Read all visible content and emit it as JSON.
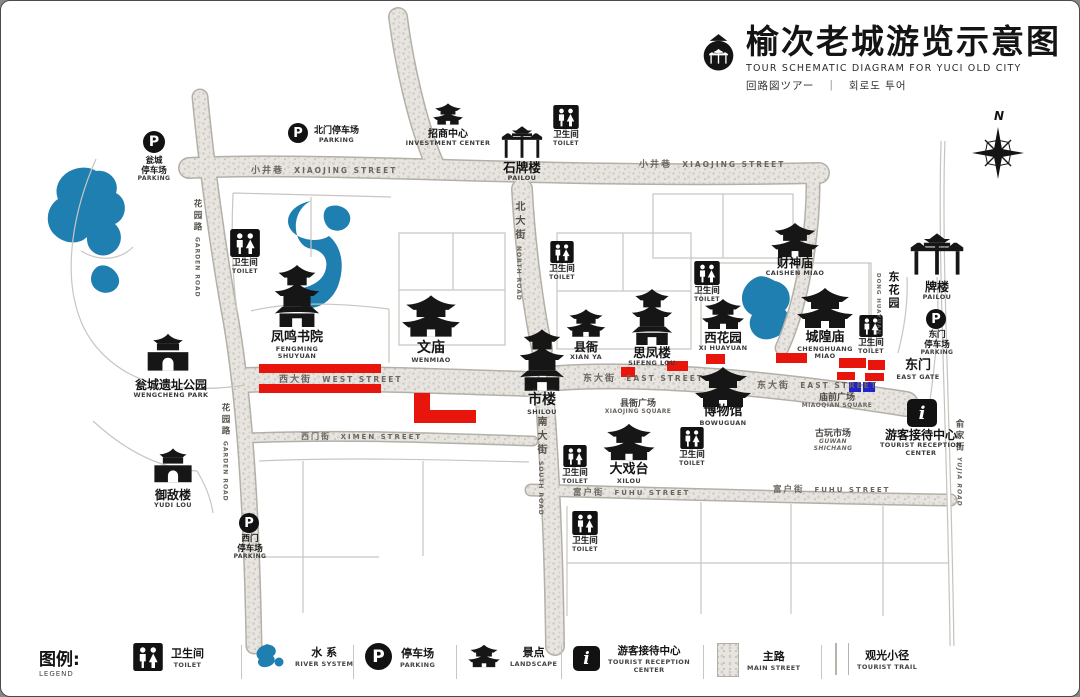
{
  "title": {
    "zh": "榆次老城游览示意图",
    "en": "TOUR SCHEMATIC DIAGRAM FOR YUCI OLD CITY",
    "sub": "回路図ツアー　｜　회로도 투어"
  },
  "compass": {
    "n": "N"
  },
  "colors": {
    "water": "#1e7fb0",
    "route_red": "#e8150d",
    "route_blue": "#2323cc",
    "road_fill": "#e8e5e0",
    "ink": "#141414"
  },
  "toilet": {
    "zh": "卫生间",
    "en": "TOILET"
  },
  "streets": {
    "xiaojing_zh": "小井巷",
    "xiaojing_en": "XIAOJING STREET",
    "west_zh": "西大街",
    "west_en": "WEST STREET",
    "east_zh": "东大街",
    "east_en": "EAST STREET",
    "ximen_zh": "西门街",
    "ximen_en": "XIMEN STREET",
    "fuhu_zh": "富户街",
    "fuhu_en": "FUHU STREET",
    "north_zh": "北大街",
    "north_en": "NORTH ROAD",
    "south_zh": "南大街",
    "south_en": "SOUTH ROAD",
    "garden_zh": "花园路",
    "garden_en": "GARDEN ROAD",
    "yujia_zh": "俞家街",
    "yujia_en": "YUJIA ROAD"
  },
  "landmarks": {
    "investment": {
      "zh": "招商中心",
      "en": "INVESTMENT CENTER"
    },
    "shipailou": {
      "zh": "石牌楼",
      "en": "PAILOU"
    },
    "fengming": {
      "zh": "凤鸣书院",
      "en": "FENGMING",
      "en2": "SHUYUAN"
    },
    "wengcheng_park": {
      "zh": "瓮城遗址公园",
      "en": "WENGCHENG PARK"
    },
    "wenmiao": {
      "zh": "文庙",
      "en": "WENMIAO"
    },
    "xianya": {
      "zh": "县衙",
      "en": "XIAN YA"
    },
    "sifenglou": {
      "zh": "思凤楼",
      "en": "SIFENG LOU"
    },
    "xihuayuan": {
      "zh": "西花园",
      "en": "XI HUAYUAN"
    },
    "chenghuangmiao": {
      "zh": "城隍庙",
      "en": "CHENGHUANG",
      "en2": "MIAO"
    },
    "caishenmiao": {
      "zh": "财神庙",
      "en": "CAISHEN MIAO"
    },
    "donghuayuan": {
      "zh": "东花园",
      "en": "DONG HUAYUAN"
    },
    "east_pailou": {
      "zh": "牌楼",
      "en": "PAILOU"
    },
    "east_gate": {
      "zh": "东门",
      "en": "EAST GATE"
    },
    "shilou": {
      "zh": "市楼",
      "en": "SHILOU"
    },
    "bowuguan": {
      "zh": "博物馆",
      "en": "BOWUGUAN"
    },
    "daxitai": {
      "zh": "大戏台",
      "en": "XILOU"
    },
    "yudilou": {
      "zh": "御敌楼",
      "en": "YUDI LOU"
    },
    "tourist_center": {
      "zh": "游客接待中心",
      "en": "TOURIST RECEPTION",
      "en2": "CENTER"
    },
    "guwan": {
      "zh": "古玩市场",
      "en": "GUWAN",
      "en2": "SHICHANG"
    },
    "xianya_square": {
      "zh": "县衙广场",
      "en": "XIAOJING SQUARE"
    },
    "miaoqian_square": {
      "zh": "庙前广场",
      "en": "MIAOQIAN SQUARE"
    }
  },
  "parkings": {
    "wengcheng": {
      "zh": "瓮城",
      "zh2": "停车场",
      "en": "PARKING"
    },
    "beimen": {
      "zh": "北门停车场",
      "en": "PARKING"
    },
    "dongmen": {
      "zh": "东门",
      "zh2": "停车场",
      "en": "PARKING"
    },
    "ximen": {
      "zh": "西门",
      "zh2": "停车场",
      "en": "PARKING"
    }
  },
  "legend": {
    "title_zh": "图例:",
    "title_en": "LEGEND",
    "items": [
      {
        "zh": "卫生间",
        "en": "TOILET"
      },
      {
        "zh": "水 系",
        "en": "RIVER SYSTEM"
      },
      {
        "zh": "停车场",
        "en": "PARKING"
      },
      {
        "zh": "景点",
        "en": "LANDSCAPE"
      },
      {
        "zh": "游客接待中心",
        "en": "TOURIST RECEPTION",
        "en2": "CENTER"
      },
      {
        "zh": "主路",
        "en": "MAIN STREET"
      },
      {
        "zh": "观光小径",
        "en": "TOURIST TRAIL"
      }
    ]
  }
}
